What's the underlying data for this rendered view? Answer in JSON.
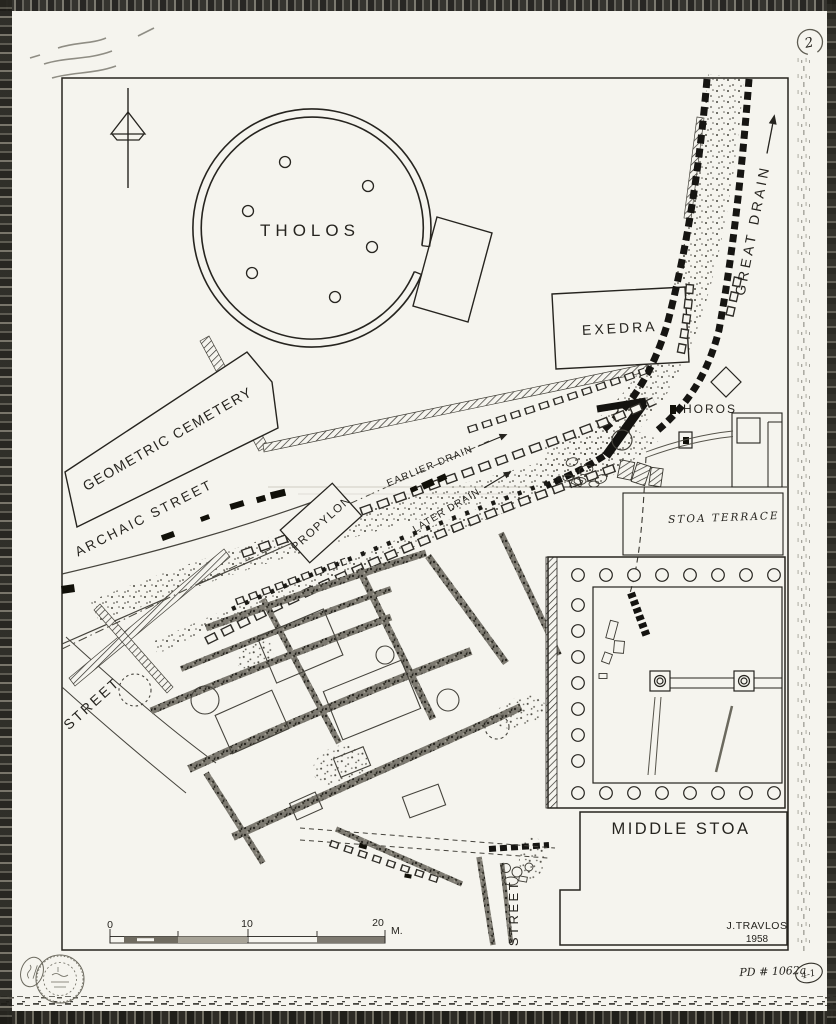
{
  "plan": {
    "labels": {
      "tholos": "THOLOS",
      "exedra": "EXEDRA",
      "great_drain": "GREAT DRAIN",
      "horos": "HOROS",
      "geometric_cemetery": "GEOMETRIC CEMETERY",
      "archaic_street": "ARCHAIC STREET",
      "propylon": "PROPYLON",
      "earlier_drain": "EARLIER DRAIN",
      "later_drain": "LATER DRAIN",
      "middle_stoa": "MIDDLE STOA",
      "street_west": "STREET",
      "street_south": "STREET",
      "stoa_terrace_pencil": "STOA TERRACE"
    },
    "scale_bar": {
      "tick0": "0",
      "tick10": "10",
      "tick20": "20",
      "unit": "M."
    },
    "credit": {
      "author": "J.TRAVLOS",
      "year": "1958"
    },
    "annotations": {
      "sheet_number": "2",
      "drawing_number": "PD # 1062a",
      "negative_ref": "4-1"
    },
    "colors": {
      "paper": "#f5f4ee",
      "ink": "#26241f",
      "pencil": "#9a988e"
    }
  }
}
